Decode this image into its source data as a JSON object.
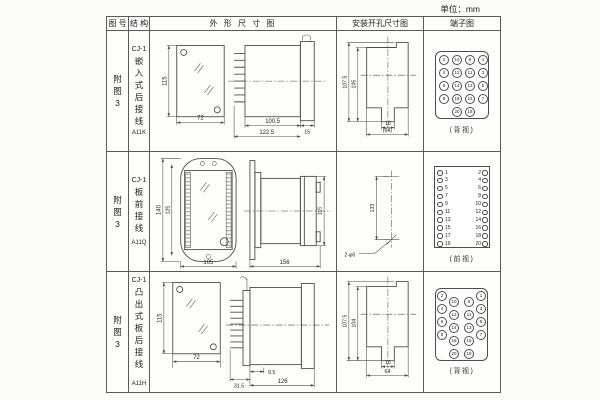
{
  "unit_label": "单位：mm",
  "table": {
    "headers": [
      "图 号",
      "结 构",
      "外 形 尺 寸 图",
      "安装开孔尺寸图",
      "端子图"
    ],
    "rows": [
      {
        "figure_no": "附图3",
        "series": "CJ-1",
        "structure": "嵌入式后接线",
        "code": "A11K",
        "outline": {
          "h": "115",
          "w": "72",
          "d1": "100.5",
          "d2": "122.5",
          "d3": "15"
        },
        "install": {
          "d1": "107.5",
          "d2": "105",
          "d3": "16",
          "d4": "(64)"
        },
        "terminal": {
          "layout": "grid",
          "view": "(背视)",
          "rows": [
            [
              2,
              10,
              9,
              1
            ],
            [
              4,
              12,
              11,
              3
            ],
            [
              6,
              14,
              13,
              5
            ],
            [
              8,
              16,
              15,
              7
            ],
            [
              null,
              20,
              18,
              null
            ]
          ]
        }
      },
      {
        "figure_no": "附图3",
        "series": "CJ-1",
        "structure": "板前接线",
        "code": "A11Q",
        "outline": {
          "h1": "140",
          "h2": "125",
          "w": "105",
          "len": "156",
          "sh": "115"
        },
        "install": {
          "d1": "133",
          "holes": "2-φ6"
        },
        "terminal": {
          "layout": "list",
          "view": "(前视)",
          "rows": [
            [
              1,
              2
            ],
            [
              3,
              4
            ],
            [
              5,
              6
            ],
            [
              7,
              8
            ],
            [
              9,
              10
            ],
            [
              11,
              12
            ],
            [
              13,
              14
            ],
            [
              15,
              16
            ],
            [
              17,
              18
            ],
            [
              19,
              20
            ]
          ]
        }
      },
      {
        "figure_no": "附图3",
        "series": "CJ-1",
        "structure": "凸出式板后接线",
        "code": "A11H",
        "outline": {
          "h": "115",
          "w": "72",
          "d1": "9.5",
          "d2": "31.5",
          "d3": "126"
        },
        "install": {
          "d1": "107.5",
          "d2": "104",
          "d3": "16",
          "d4": "64"
        },
        "terminal": {
          "layout": "staggered",
          "view": "(背视)",
          "rows": [
            [
              2,
              10,
              9,
              1
            ],
            [
              4,
              12,
              11,
              3
            ],
            [
              6,
              14,
              13,
              5
            ],
            [
              8,
              16,
              15,
              7
            ],
            [
              null,
              20,
              18,
              null
            ]
          ]
        }
      }
    ]
  }
}
